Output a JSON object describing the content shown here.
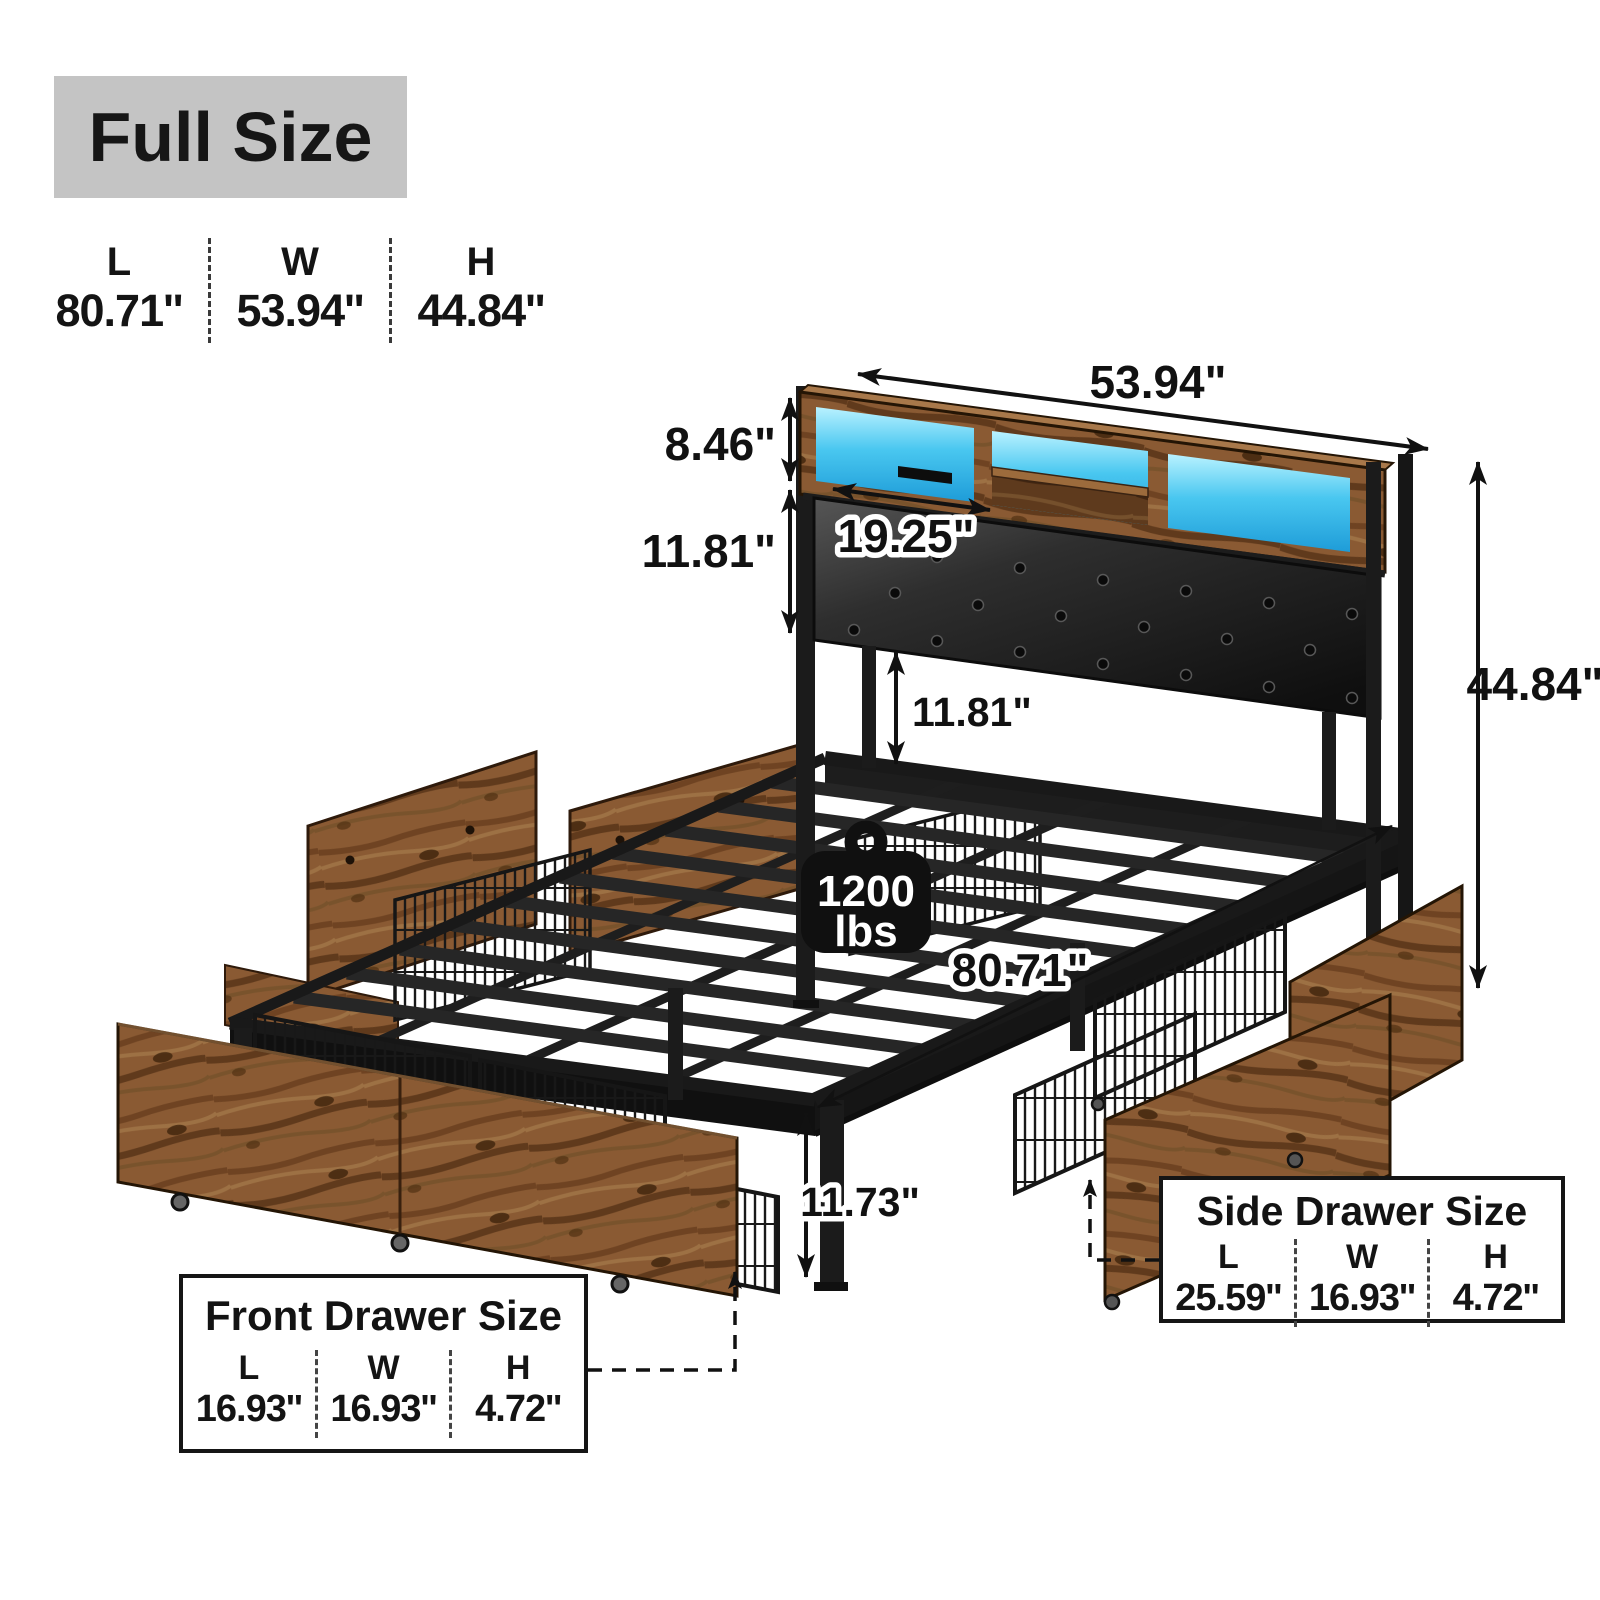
{
  "size_header": {
    "label": "Full Size",
    "dimensions": [
      {
        "axis": "L",
        "value": "80.71''"
      },
      {
        "axis": "W",
        "value": "53.94''"
      },
      {
        "axis": "H",
        "value": "44.84''"
      }
    ]
  },
  "diagram": {
    "headboard_width": "53.94\"",
    "hutch_height": "8.46\"",
    "hutch_opening_width": "19.25\"",
    "headboard_panel_height": "11.81\"",
    "headboard_clearance": "11.81\"",
    "overall_height": "44.84\"",
    "bed_length": "80.71\"",
    "underbed_clearance": "11.73\"",
    "weight_capacity_value": "1200",
    "weight_capacity_unit": "lbs"
  },
  "front_drawer_box": {
    "title": "Front Drawer Size",
    "dimensions": [
      {
        "axis": "L",
        "value": "16.93''"
      },
      {
        "axis": "W",
        "value": "16.93''"
      },
      {
        "axis": "H",
        "value": "4.72''"
      }
    ]
  },
  "side_drawer_box": {
    "title": "Side Drawer Size",
    "dimensions": [
      {
        "axis": "L",
        "value": "25.59''"
      },
      {
        "axis": "W",
        "value": "16.93''"
      },
      {
        "axis": "H",
        "value": "4.72''"
      }
    ]
  },
  "colors": {
    "header_badge_bg": "#c4c4c4",
    "text": "#141414",
    "rustic_wood": "#8a5a33",
    "dark_wood": "#5e3a1d",
    "led_blue": "#49c7f0",
    "metal_black": "#1b1b1b",
    "leather_black": "#2c2c2c"
  }
}
